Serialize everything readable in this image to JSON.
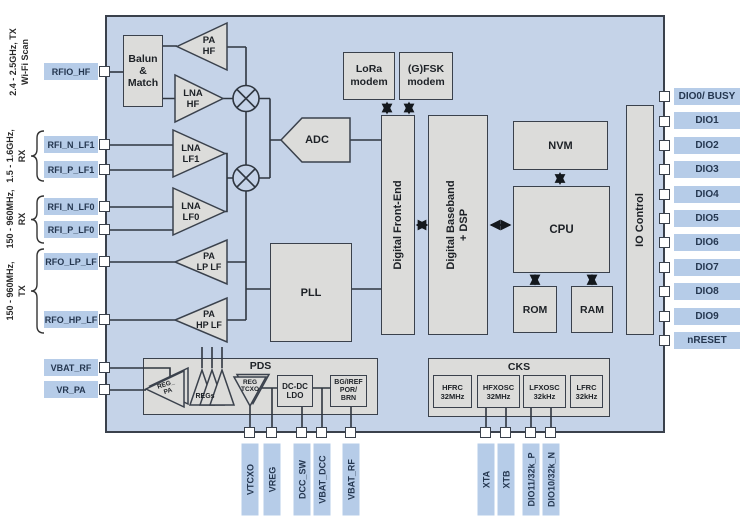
{
  "side_groups": {
    "hf": {
      "line1": "2.4 - 2.5GHz, TX",
      "line2": "Wi-Fi Scan"
    },
    "lf1": {
      "line1": "1.5 - 1.6GHz,",
      "line2": "RX"
    },
    "lf0_rx": {
      "line1": "150 - 960MHz,",
      "line2": "RX"
    },
    "lf0_tx": {
      "line1": "150 - 960MHz,",
      "line2": "TX"
    }
  },
  "blocks": {
    "balun": "Balun\n&\nMatch",
    "pa_hf": "PA\nHF",
    "lna_hf": "LNA\nHF",
    "lna_lf1": "LNA\nLF1",
    "lna_lf0": "LNA\nLF0",
    "pa_lp_lf": "PA\nLP LF",
    "pa_hp_lf": "PA\nHP LF",
    "adc": "ADC",
    "pll": "PLL",
    "dfe": "Digital Front-End",
    "dbb": "Digital Baseband\n+ DSP",
    "lora": "LoRa\nmodem",
    "gfsk": "(G)FSK\nmodem",
    "nvm": "NVM",
    "cpu": "CPU",
    "rom": "ROM",
    "ram": "RAM",
    "io_control": "IO Control",
    "pds": {
      "title": "PDS",
      "reg_pa": "REG_\nPA",
      "regs": "REGs",
      "reg_tcxo": "REG\nTCXO",
      "dcdc_ldo": "DC-DC\nLDO",
      "bg_iref": "BG/IREF\nPOR/\nBRN"
    },
    "cks": {
      "title": "CKS",
      "osc1": "HFRC\n32MHz",
      "osc2": "HFXOSC\n32MHz",
      "osc3": "LFXOSC\n32kHz",
      "osc4": "LFRC\n32kHz"
    }
  },
  "pins": {
    "left": [
      "RFIO_HF",
      "RFI_N_LF1",
      "RFI_P_LF1",
      "RFI_N_LF0",
      "RFI_P_LF0",
      "RFO_LP_LF",
      "RFO_HP_LF",
      "VBAT_RF",
      "VR_PA"
    ],
    "right": [
      "DIO0/ BUSY",
      "DIO1",
      "DIO2",
      "DIO3",
      "DIO4",
      "DIO5",
      "DIO6",
      "DIO7",
      "DIO8",
      "DIO9",
      "nRESET"
    ],
    "bottom_left": [
      "VTCXO",
      "VREG",
      "DCC_SW",
      "VBAT_DCC",
      "VBAT_RF"
    ],
    "bottom_right": [
      "XTA",
      "XTB",
      "DIO11/32k_P",
      "DIO10/32k_N"
    ]
  },
  "colors": {
    "chip_fill": "#c5d3e8",
    "block_fill": "#dcdcda",
    "pin_label_fill": "#b6cce8",
    "wire": "#2f3640",
    "pin_text": "#253750"
  }
}
